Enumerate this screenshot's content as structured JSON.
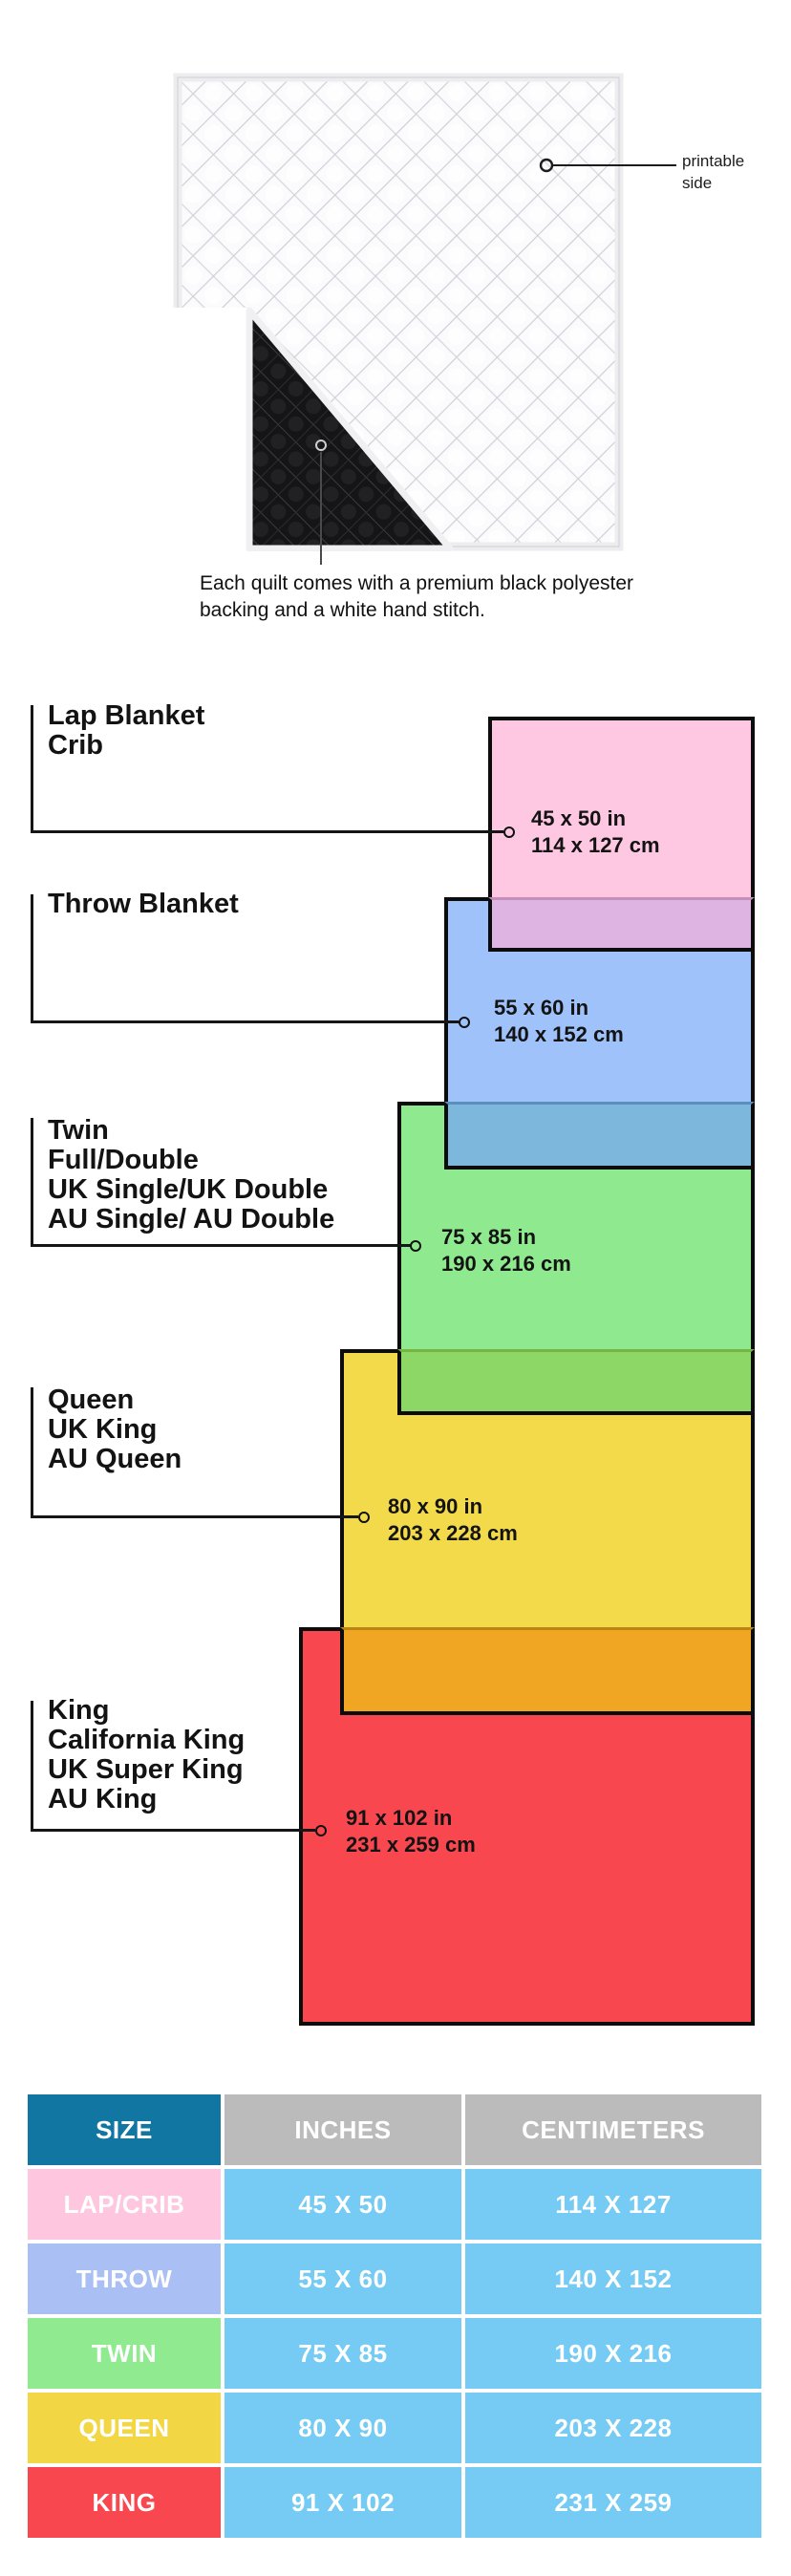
{
  "quilt": {
    "printable_label": "printable side",
    "caption_line1": "Each quilt comes with a premium black polyester",
    "caption_line2": "backing and a white hand stitch."
  },
  "diagram": {
    "sizes": [
      {
        "id": "lap",
        "labels": [
          "Lap Blanket",
          "Crib"
        ],
        "inches": "45 x 50 in",
        "cm": "114 x 127 cm",
        "color": "#FFC8E2"
      },
      {
        "id": "throw",
        "labels": [
          "Throw Blanket"
        ],
        "inches": "55 x 60 in",
        "cm": "140 x 152 cm",
        "color": "#9FC2FB"
      },
      {
        "id": "twin",
        "labels": [
          "Twin",
          "Full/Double",
          "UK Single/UK Double",
          "AU Single/ AU Double"
        ],
        "inches": "75 x 85 in",
        "cm": "190 x 216 cm",
        "color": "#8FE98F"
      },
      {
        "id": "queen",
        "labels": [
          "Queen",
          "UK King",
          "AU Queen"
        ],
        "inches": "80 x 90 in",
        "cm": "203 x 228 cm",
        "color": "#F3DA4A"
      },
      {
        "id": "king",
        "labels": [
          "King",
          "California King",
          "UK Super King",
          "AU King"
        ],
        "inches": "91 x 102 in",
        "cm": "231 x 259 cm",
        "color": "#F8474E"
      }
    ],
    "overlap_colors": {
      "lap_throw": "#DEB4E2",
      "throw_twin": "#7EB7DC",
      "twin_queen": "#8CD766",
      "queen_king": "#F1A623"
    }
  },
  "table": {
    "headers": {
      "size": "SIZE",
      "inches": "INCHES",
      "cm": "CENTIMETERS"
    },
    "header_colors": {
      "size_bg": "#1176A2",
      "other_bg": "#BBBBBB",
      "cell_bg": "#75CBF3"
    },
    "rows": [
      {
        "size": "LAP/CRIB",
        "inches": "45 X 50",
        "cm": "114 X 127",
        "color": "#FFC6DF"
      },
      {
        "size": "THROW",
        "inches": "55 X 60",
        "cm": "140 X 152",
        "color": "#AAC0F5"
      },
      {
        "size": "TWIN",
        "inches": "75 X 85",
        "cm": "190 X 216",
        "color": "#90EB90"
      },
      {
        "size": "QUEEN",
        "inches": "80 X 90",
        "cm": "203 X 228",
        "color": "#F3D644"
      },
      {
        "size": "KING",
        "inches": "91 X 102",
        "cm": "231 X 259",
        "color": "#F8474E"
      }
    ]
  }
}
